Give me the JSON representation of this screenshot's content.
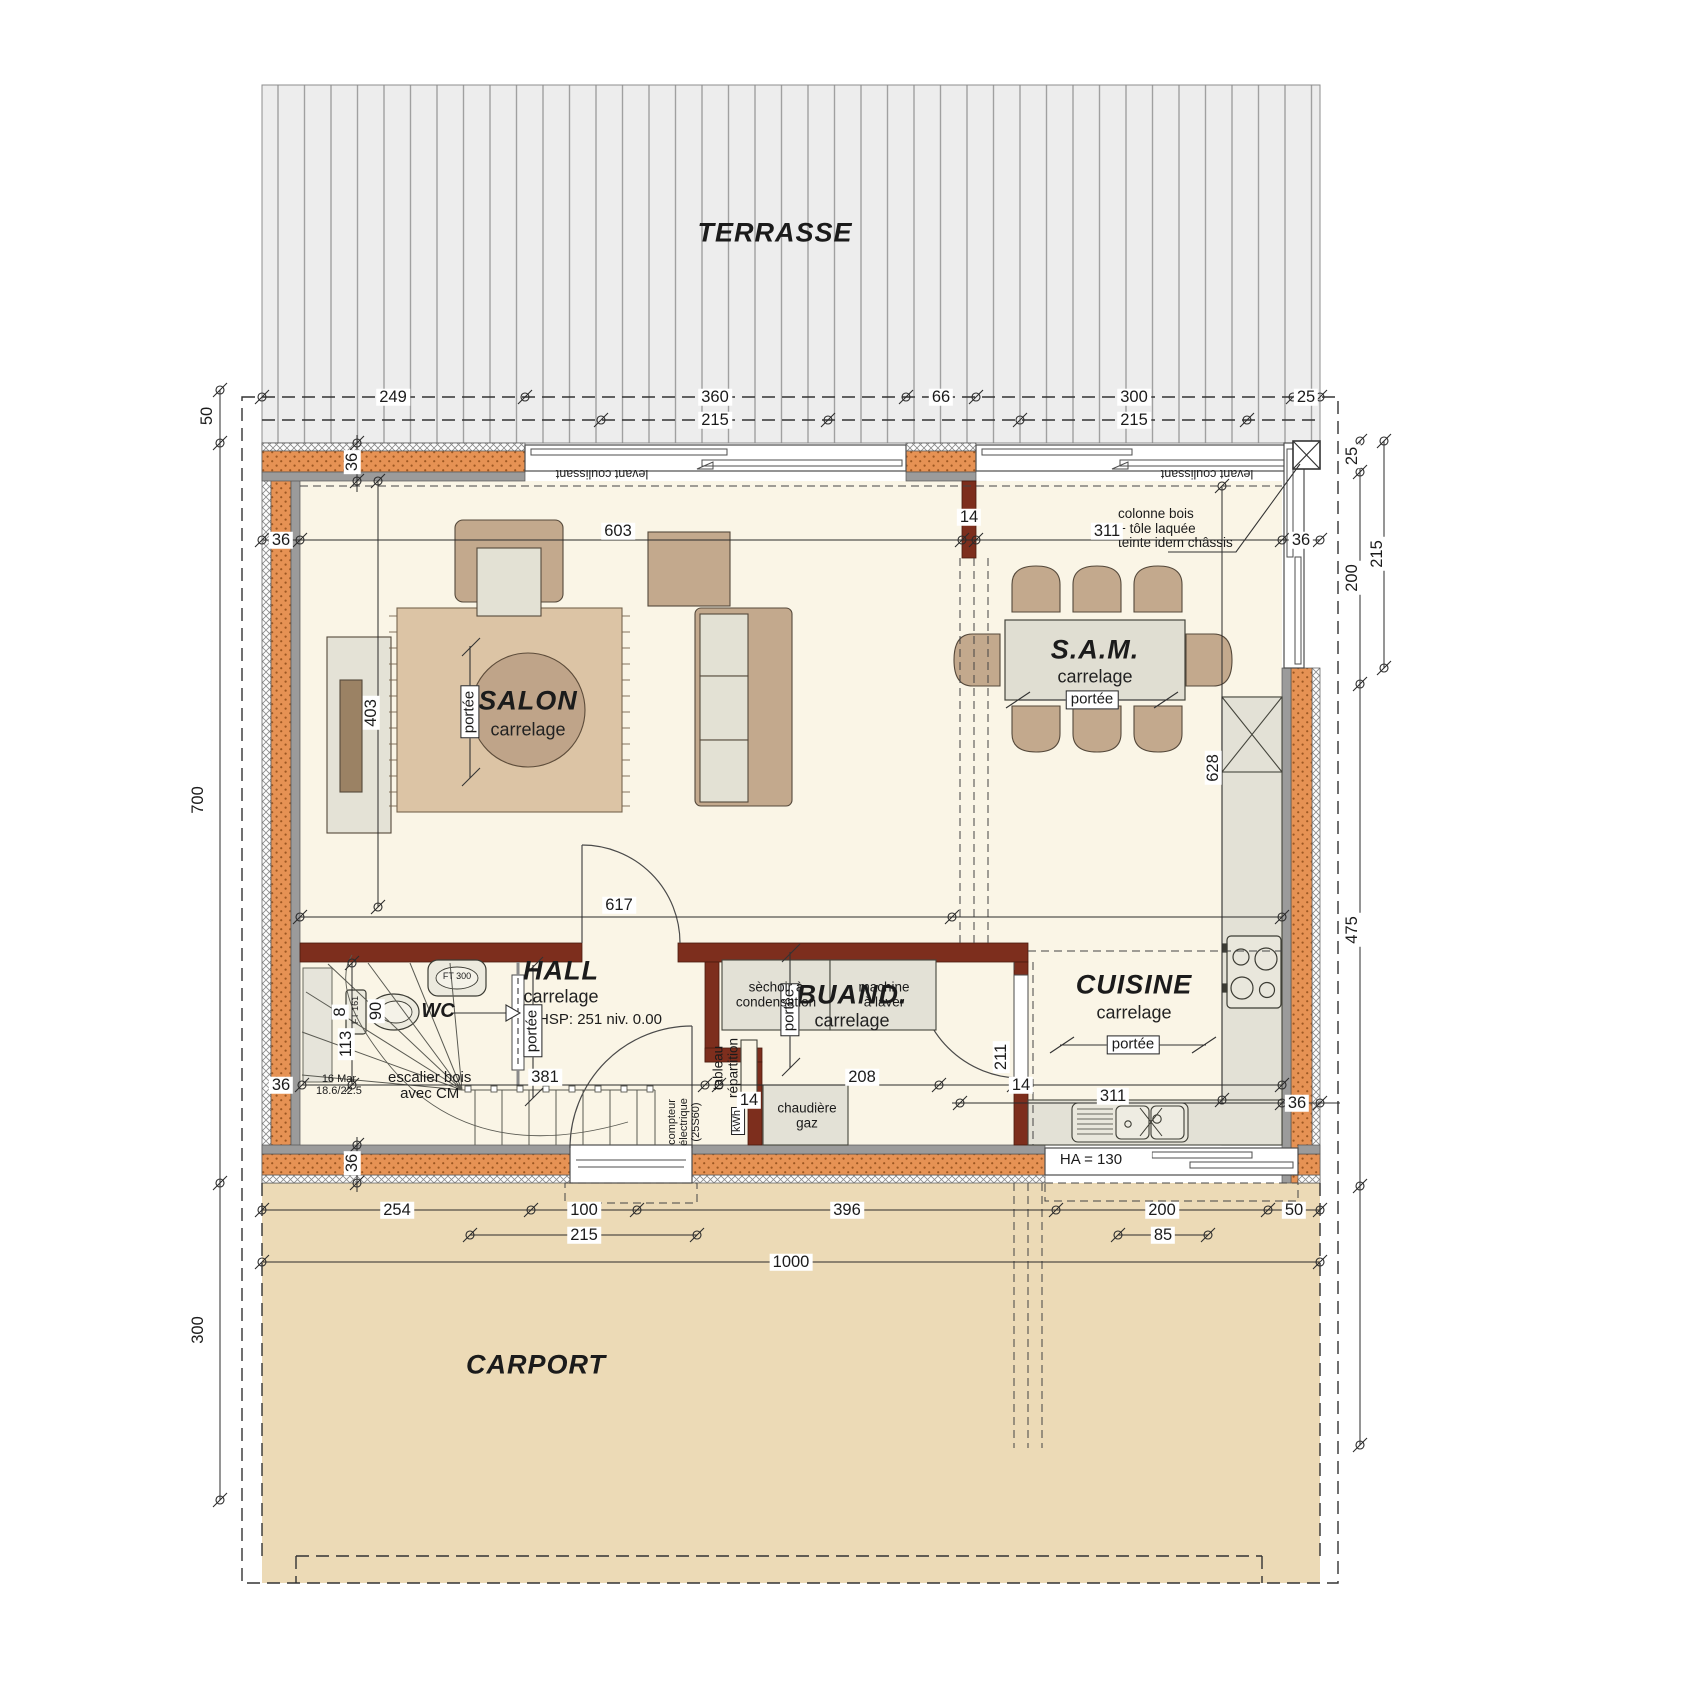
{
  "drawing": {
    "type": "architectural floor plan – ground floor",
    "scale_note": "dimensions in centimetres"
  },
  "labels": {
    "rooms": [
      {
        "name": "terrasse-label",
        "text": "TERRASSE",
        "x": 775,
        "y": 233,
        "style": "room"
      },
      {
        "name": "salon-label",
        "text": "SALON",
        "x": 528,
        "y": 701,
        "style": "room"
      },
      {
        "name": "sam-label",
        "text": "S.A.M.",
        "x": 1095,
        "y": 650,
        "style": "room"
      },
      {
        "name": "hall-label",
        "text": "HALL",
        "x": 561,
        "y": 971,
        "style": "room"
      },
      {
        "name": "wc-label",
        "text": "WC",
        "x": 438,
        "y": 1012,
        "style": "room-sm"
      },
      {
        "name": "buanderie-label",
        "text": "BUAND.",
        "x": 852,
        "y": 995,
        "style": "room"
      },
      {
        "name": "cuisine-label",
        "text": "CUISINE",
        "x": 1134,
        "y": 985,
        "style": "room"
      },
      {
        "name": "carport-label",
        "text": "CARPORT",
        "x": 536,
        "y": 1365,
        "style": "room"
      }
    ],
    "materials": [
      {
        "name": "salon-floor-material",
        "text": "carrelage",
        "x": 528,
        "y": 730,
        "style": "sub"
      },
      {
        "name": "sam-floor-material",
        "text": "carrelage",
        "x": 1095,
        "y": 677,
        "style": "sub"
      },
      {
        "name": "hall-floor-material",
        "text": "carrelage",
        "x": 561,
        "y": 997,
        "style": "sub"
      },
      {
        "name": "buanderie-floor-material",
        "text": "carrelage",
        "x": 852,
        "y": 1021,
        "style": "sub"
      },
      {
        "name": "cuisine-floor-material",
        "text": "carrelage",
        "x": 1134,
        "y": 1013,
        "style": "sub"
      },
      {
        "name": "hall-ceiling-height",
        "text": "HSP: 251 niv. 0.00",
        "x": 600,
        "y": 1020,
        "style": "note15"
      }
    ],
    "portee": [
      {
        "name": "salon-portee",
        "text": "portée",
        "x": 470,
        "y": 712,
        "rot": -90,
        "style": "portee"
      },
      {
        "name": "sam-portee",
        "text": "portée",
        "x": 1092,
        "y": 700,
        "style": "portee"
      },
      {
        "name": "hall-portee",
        "text": "portée",
        "x": 533,
        "y": 1031,
        "rot": -90,
        "style": "portee"
      },
      {
        "name": "buanderie-portee",
        "text": "portée",
        "x": 790,
        "y": 1010,
        "rot": -90,
        "style": "portee"
      },
      {
        "name": "cuisine-portee",
        "text": "portée",
        "x": 1133,
        "y": 1045,
        "style": "portee"
      }
    ],
    "windows": [
      {
        "name": "sliding-window-left-label",
        "text": "levant coulissant",
        "x": 602,
        "y": 473,
        "rot": 180,
        "style": "tiny"
      },
      {
        "name": "sliding-window-right-label",
        "text": "levant coulissant",
        "x": 1207,
        "y": 473,
        "rot": 180,
        "style": "tiny"
      },
      {
        "name": "kitchen-window-sill-height",
        "text": "HA = 130",
        "x": 1102,
        "y": 1160,
        "style": "ha"
      }
    ],
    "annotations": [
      {
        "name": "column-note",
        "text": "colonne bois\n+ tôle laquée\nteinte idem châssis",
        "x": 1118,
        "y": 529,
        "style": "note",
        "anchor": "l"
      },
      {
        "name": "dryer-label",
        "text": "sèchoir à\ncondensation",
        "x": 776,
        "y": 995,
        "style": "app"
      },
      {
        "name": "washer-label",
        "text": "machine\nà laver",
        "x": 884,
        "y": 995,
        "style": "app"
      },
      {
        "name": "boiler-label",
        "text": "chaudière\ngaz",
        "x": 807,
        "y": 1116,
        "style": "app"
      },
      {
        "name": "electrical-panel-label",
        "text": "tableau\nrépartition",
        "x": 726,
        "y": 1068,
        "rot": -90,
        "style": "app"
      },
      {
        "name": "electric-meter-label",
        "text": "compteur\nélectrique\n(25S60)",
        "x": 685,
        "y": 1122,
        "rot": -90,
        "style": "tinyv"
      },
      {
        "name": "kwh-label",
        "text": "kWh",
        "x": 738,
        "y": 1121,
        "rot": -90,
        "style": "boxed"
      },
      {
        "name": "stair-note",
        "text": "escalier bois\navec CM",
        "x": 388,
        "y": 1086,
        "style": "note15",
        "anchor": "l"
      },
      {
        "name": "stair-spec",
        "text": "16 Mar\n18.6/22.5",
        "x": 316,
        "y": 1086,
        "style": "tinyv",
        "anchor": "l"
      },
      {
        "name": "wc-basin-ref",
        "text": "FT 300",
        "x": 457,
        "y": 977,
        "style": "micro"
      },
      {
        "name": "wc-toilet-ref",
        "text": "FT 161",
        "x": 356,
        "y": 1010,
        "rot": -90,
        "style": "micro"
      }
    ],
    "dimensions": [
      {
        "name": "dim-top-249",
        "text": "249",
        "x": 393,
        "y": 397,
        "style": "dim"
      },
      {
        "name": "dim-top-360",
        "text": "360",
        "x": 715,
        "y": 397,
        "style": "dim"
      },
      {
        "name": "dim-top-66",
        "text": "66",
        "x": 941,
        "y": 397,
        "style": "dim"
      },
      {
        "name": "dim-top-300",
        "text": "300",
        "x": 1134,
        "y": 397,
        "style": "dim"
      },
      {
        "name": "dim-top-25",
        "text": "25",
        "x": 1306,
        "y": 397,
        "style": "dim"
      },
      {
        "name": "dim-top-215-left",
        "text": "215",
        "x": 715,
        "y": 420,
        "style": "dim"
      },
      {
        "name": "dim-top-215-right",
        "text": "215",
        "x": 1134,
        "y": 420,
        "style": "dim"
      },
      {
        "name": "dim-left-50",
        "text": "50",
        "x": 207,
        "y": 416,
        "rot": -90,
        "style": "dim"
      },
      {
        "name": "dim-left-700",
        "text": "700",
        "x": 198,
        "y": 800,
        "rot": -90,
        "style": "dim"
      },
      {
        "name": "dim-left-300",
        "text": "300",
        "x": 198,
        "y": 1330,
        "rot": -90,
        "style": "dim"
      },
      {
        "name": "dim-right-25",
        "text": "25",
        "x": 1352,
        "y": 456,
        "rot": -90,
        "style": "dim"
      },
      {
        "name": "dim-right-200",
        "text": "200",
        "x": 1352,
        "y": 578,
        "rot": -90,
        "style": "dim"
      },
      {
        "name": "dim-right-215",
        "text": "215",
        "x": 1377,
        "y": 554,
        "rot": -90,
        "style": "dim"
      },
      {
        "name": "dim-right-475",
        "text": "475",
        "x": 1352,
        "y": 930,
        "rot": -90,
        "style": "dim"
      },
      {
        "name": "dim-wall-36-left",
        "text": "36",
        "x": 281,
        "y": 540,
        "style": "dim"
      },
      {
        "name": "dim-salon-603",
        "text": "603",
        "x": 618,
        "y": 531,
        "style": "dim"
      },
      {
        "name": "dim-sam-311",
        "text": "311",
        "x": 1107,
        "y": 531,
        "style": "dim"
      },
      {
        "name": "dim-wall-36-right",
        "text": "36",
        "x": 1301,
        "y": 540,
        "style": "dim"
      },
      {
        "name": "dim-wall-36-top",
        "text": "36",
        "x": 352,
        "y": 462,
        "rot": -90,
        "style": "dim"
      },
      {
        "name": "dim-pier-14",
        "text": "14",
        "x": 969,
        "y": 517,
        "style": "dim"
      },
      {
        "name": "dim-salon-403",
        "text": "403",
        "x": 371,
        "y": 713,
        "rot": -90,
        "style": "dim"
      },
      {
        "name": "dim-salon-617",
        "text": "617",
        "x": 619,
        "y": 905,
        "style": "dim"
      },
      {
        "name": "dim-cuisine-628",
        "text": "628",
        "x": 1213,
        "y": 768,
        "rot": -90,
        "style": "dim"
      },
      {
        "name": "dim-stair-8",
        "text": "8",
        "x": 340,
        "y": 1012,
        "rot": -90,
        "style": "dim"
      },
      {
        "name": "dim-stair-113",
        "text": "113",
        "x": 346,
        "y": 1044,
        "rot": -90,
        "style": "dim"
      },
      {
        "name": "dim-wc-90",
        "text": "90",
        "x": 376,
        "y": 1011,
        "rot": -90,
        "style": "dim"
      },
      {
        "name": "dim-hall-381",
        "text": "381",
        "x": 545,
        "y": 1077,
        "style": "dim"
      },
      {
        "name": "dim-buand-208",
        "text": "208",
        "x": 862,
        "y": 1077,
        "style": "dim"
      },
      {
        "name": "dim-wall-14a",
        "text": "14",
        "x": 749,
        "y": 1100,
        "style": "dim"
      },
      {
        "name": "dim-wall-14b",
        "text": "14",
        "x": 1021,
        "y": 1085,
        "style": "dim"
      },
      {
        "name": "dim-buand-211",
        "text": "211",
        "x": 1001,
        "y": 1057,
        "rot": -90,
        "style": "dim"
      },
      {
        "name": "dim-cuisine-311",
        "text": "311",
        "x": 1113,
        "y": 1096,
        "style": "dim"
      },
      {
        "name": "dim-wall-36-kitchen",
        "text": "36",
        "x": 1297,
        "y": 1103,
        "style": "dim"
      },
      {
        "name": "dim-wall-36-bottom",
        "text": "36",
        "x": 352,
        "y": 1163,
        "rot": -90,
        "style": "dim"
      },
      {
        "name": "dim-wall-36-hall",
        "text": "36",
        "x": 281,
        "y": 1085,
        "style": "dim"
      },
      {
        "name": "dim-bottom-254",
        "text": "254",
        "x": 397,
        "y": 1210,
        "style": "dim"
      },
      {
        "name": "dim-bottom-100",
        "text": "100",
        "x": 584,
        "y": 1210,
        "style": "dim"
      },
      {
        "name": "dim-bottom-396",
        "text": "396",
        "x": 847,
        "y": 1210,
        "style": "dim"
      },
      {
        "name": "dim-bottom-200",
        "text": "200",
        "x": 1162,
        "y": 1210,
        "style": "dim"
      },
      {
        "name": "dim-bottom-50",
        "text": "50",
        "x": 1294,
        "y": 1210,
        "style": "dim"
      },
      {
        "name": "dim-bottom-215",
        "text": "215",
        "x": 584,
        "y": 1235,
        "style": "dim"
      },
      {
        "name": "dim-bottom-85",
        "text": "85",
        "x": 1163,
        "y": 1235,
        "style": "dim"
      },
      {
        "name": "dim-bottom-1000",
        "text": "1000",
        "x": 791,
        "y": 1262,
        "style": "dim"
      }
    ]
  }
}
